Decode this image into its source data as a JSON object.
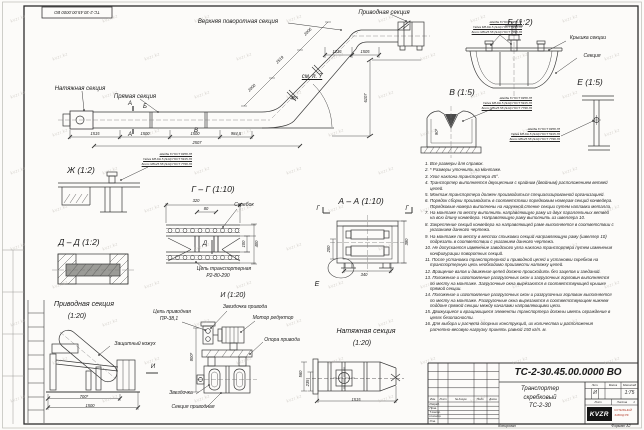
{
  "frame": {
    "stamp_top": "ТС-2-30.45.00.0000 ВО",
    "watermark": "kvzr.kz",
    "copied": "Копировал",
    "format": "Формат А2"
  },
  "gost": {
    "l1": "Шайба 8 ГОСТ 6958-78",
    "l2": "Гайка М8-6Н.5 (S13) ГОСТ 5915-70",
    "l3": "Болт М8х25.58 (S13) ГОСТ 7798-70"
  },
  "main": {
    "top_section": "Верхняя поворотная секция",
    "drive_section": "Приводная секция",
    "tension_section": "Натяжная секция",
    "straight_section": "Прямая секция",
    "see_note": "см. п. 7",
    "angle": "45°",
    "mark_a": "А",
    "mark_b": "Б",
    "mark_v": "В",
    "d1": "1515",
    "d2": "1500",
    "d3": "1500",
    "d4": "984,5",
    "d5": "2507",
    "i1": "2000",
    "i2": "2519",
    "i3": "2006",
    "t1": "1216",
    "t2": "1505",
    "h": "6107"
  },
  "vb": {
    "title": "Б  (1:2)",
    "cover": "Крышка секции",
    "section": "Секция"
  },
  "vv": {
    "title": "В  (1:5)",
    "dim": "90*"
  },
  "ve": {
    "title": "Е  (1:5)"
  },
  "vzh": {
    "title": "Ж  (1:2)"
  },
  "vdd": {
    "title": "Д – Д  (1:2)"
  },
  "vgg": {
    "title": "Г – Г  (1:10)",
    "scraper": "Скребок",
    "chain1": "Цепь транспортерная",
    "chain2": "Р2-80-290",
    "mark": "Д",
    "w": "320",
    "inner": "80",
    "h1": "100",
    "h2": "400"
  },
  "vaa": {
    "title": "А – А  (1:10)",
    "g": "Г",
    "e": "Е",
    "left": "200",
    "right": "380",
    "bottom": "340"
  },
  "vd": {
    "title1": "Приводная секция",
    "title2": "(1:20)",
    "cover": "Защитный кожух",
    "chain1": "Цепь приводная",
    "chain2": "ПР-38,1",
    "sprocket_drive": "Звездочка привода",
    "motor": "Мотор редуктор",
    "support": "Опора привода",
    "sprocket": "Звездочка",
    "section": "Секция приводная",
    "mark": "И",
    "b1": "700*",
    "b2": "1500"
  },
  "vi": {
    "title": "И  (1:20)",
    "left": "800*"
  },
  "vt": {
    "title1": "Натяжная секция",
    "title2": "(1:20)",
    "h1": "560",
    "h2": "235",
    "w": "1515"
  },
  "notes": [
    "1. Все размеры для справок.",
    "2. * Размеры уточнить на монтаже.",
    "3. Угол наклона транспортера 45°.",
    "4. Транспортер выполняется двухцепным с крайним (двойным) расположением ветвей цепей.",
    "5. Монтаж транспортера должен производиться специализированной организацией.",
    "6. Порядок сборки производить в соответствии порядковым номерам секций конвейера. Порядковые номера выполнены на наружной стенке секции путем наплавки металла.",
    "7. На монтаже по месту выполнить направляющую раму из двух параллельных ветвей на всю длину конвейера. Направляющую раму выполнить из швеллера 10.",
    "8. Закрепление секций конвейера на направляющей раме выполняется в соответствии с указанием данного чертежа.",
    "9. На монтаже по месту в местах стыковки секций направляющую раму (швеллер 10) подрезать в соответствии с указанием данного чертежа.",
    "10. Не допускается изменение заводского угла наклона транспортера путем изменения конфигурации поворотных секций.",
    "11. После установки транспортерной и приводной цепей и установки скребков на транспортерную цепь необходимо произвести натяжку цепей.",
    "12. Вращение валов и движение цепей должно происходить без зацепов и заеданий.",
    "13. Положение и изготовление разгрузочных окон и загрузочных горловин выполняется по месту на монтаже. Загрузочные окна вырезаются в соответствующей крышке прямой секции.",
    "14. Положение и изготовление разгрузочных окон и разгрузочных горловин выполняется по месту на монтаже. Разгрузочные окна вырезаются в соответствующем нижнем поддоне прямой секции между каналами направляющими цепи.",
    "15. Движущиеся и вращающиеся элементы транспортера должны иметь ограждение в целях безопасности.",
    "16. Для выбора и расчета опорных конструкций, их количества и расположения расчетно-весовую нагрузку принять равной 150 кг/п. м."
  ],
  "tb": {
    "number": "ТС-2-30.45.00.0000  ВО",
    "name1": "Транспортер",
    "name2": "скребковый",
    "name3": "ТС-2-30",
    "izm": "Изм.",
    "list": "Лист",
    "doc": "№ докум.",
    "sign": "Подп.",
    "date": "Дата",
    "r1": "Разраб.",
    "r2": "Пров.",
    "r3": "Т.контр.",
    "r4": "Н.контр.",
    "r5": "Утв.",
    "lit": "Лит.",
    "mass": "Масса",
    "scale": "Масштаб",
    "lit_v": "И",
    "scale_v": "1:75",
    "sheet": "Лист",
    "sheets": "Листов",
    "sheets_v": "1",
    "logo": "KVZR",
    "logo1": "КОТЕЛЬНЫЙ",
    "logo2": "ЗАВОД РФ"
  }
}
